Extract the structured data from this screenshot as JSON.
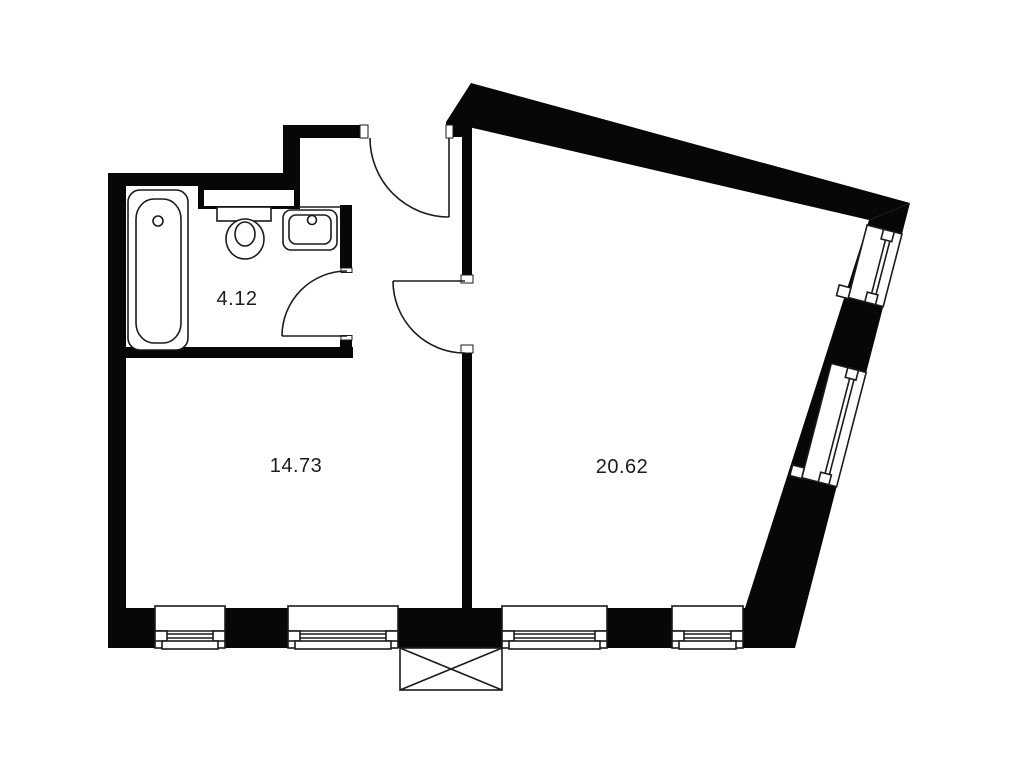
{
  "plan": {
    "type": "apartment-floor-plan",
    "rooms": [
      {
        "id": "bathroom",
        "area_label": "4.12"
      },
      {
        "id": "room-left",
        "area_label": "14.73"
      },
      {
        "id": "room-right",
        "area_label": "20.62"
      }
    ],
    "fixtures": [
      "bathtub",
      "toilet",
      "sink"
    ],
    "doors": [
      "entrance-door",
      "bathroom-door",
      "interior-door"
    ],
    "windows": [
      "bottom-window-1",
      "bottom-window-2",
      "bottom-window-3",
      "bottom-window-4",
      "right-window-upper",
      "right-window-lower"
    ],
    "marker": "crossed-box",
    "colors": {
      "wall": "#070707",
      "line": "#1b1b1b",
      "background": "#ffffff",
      "label_text": "#1c1c1c"
    }
  }
}
